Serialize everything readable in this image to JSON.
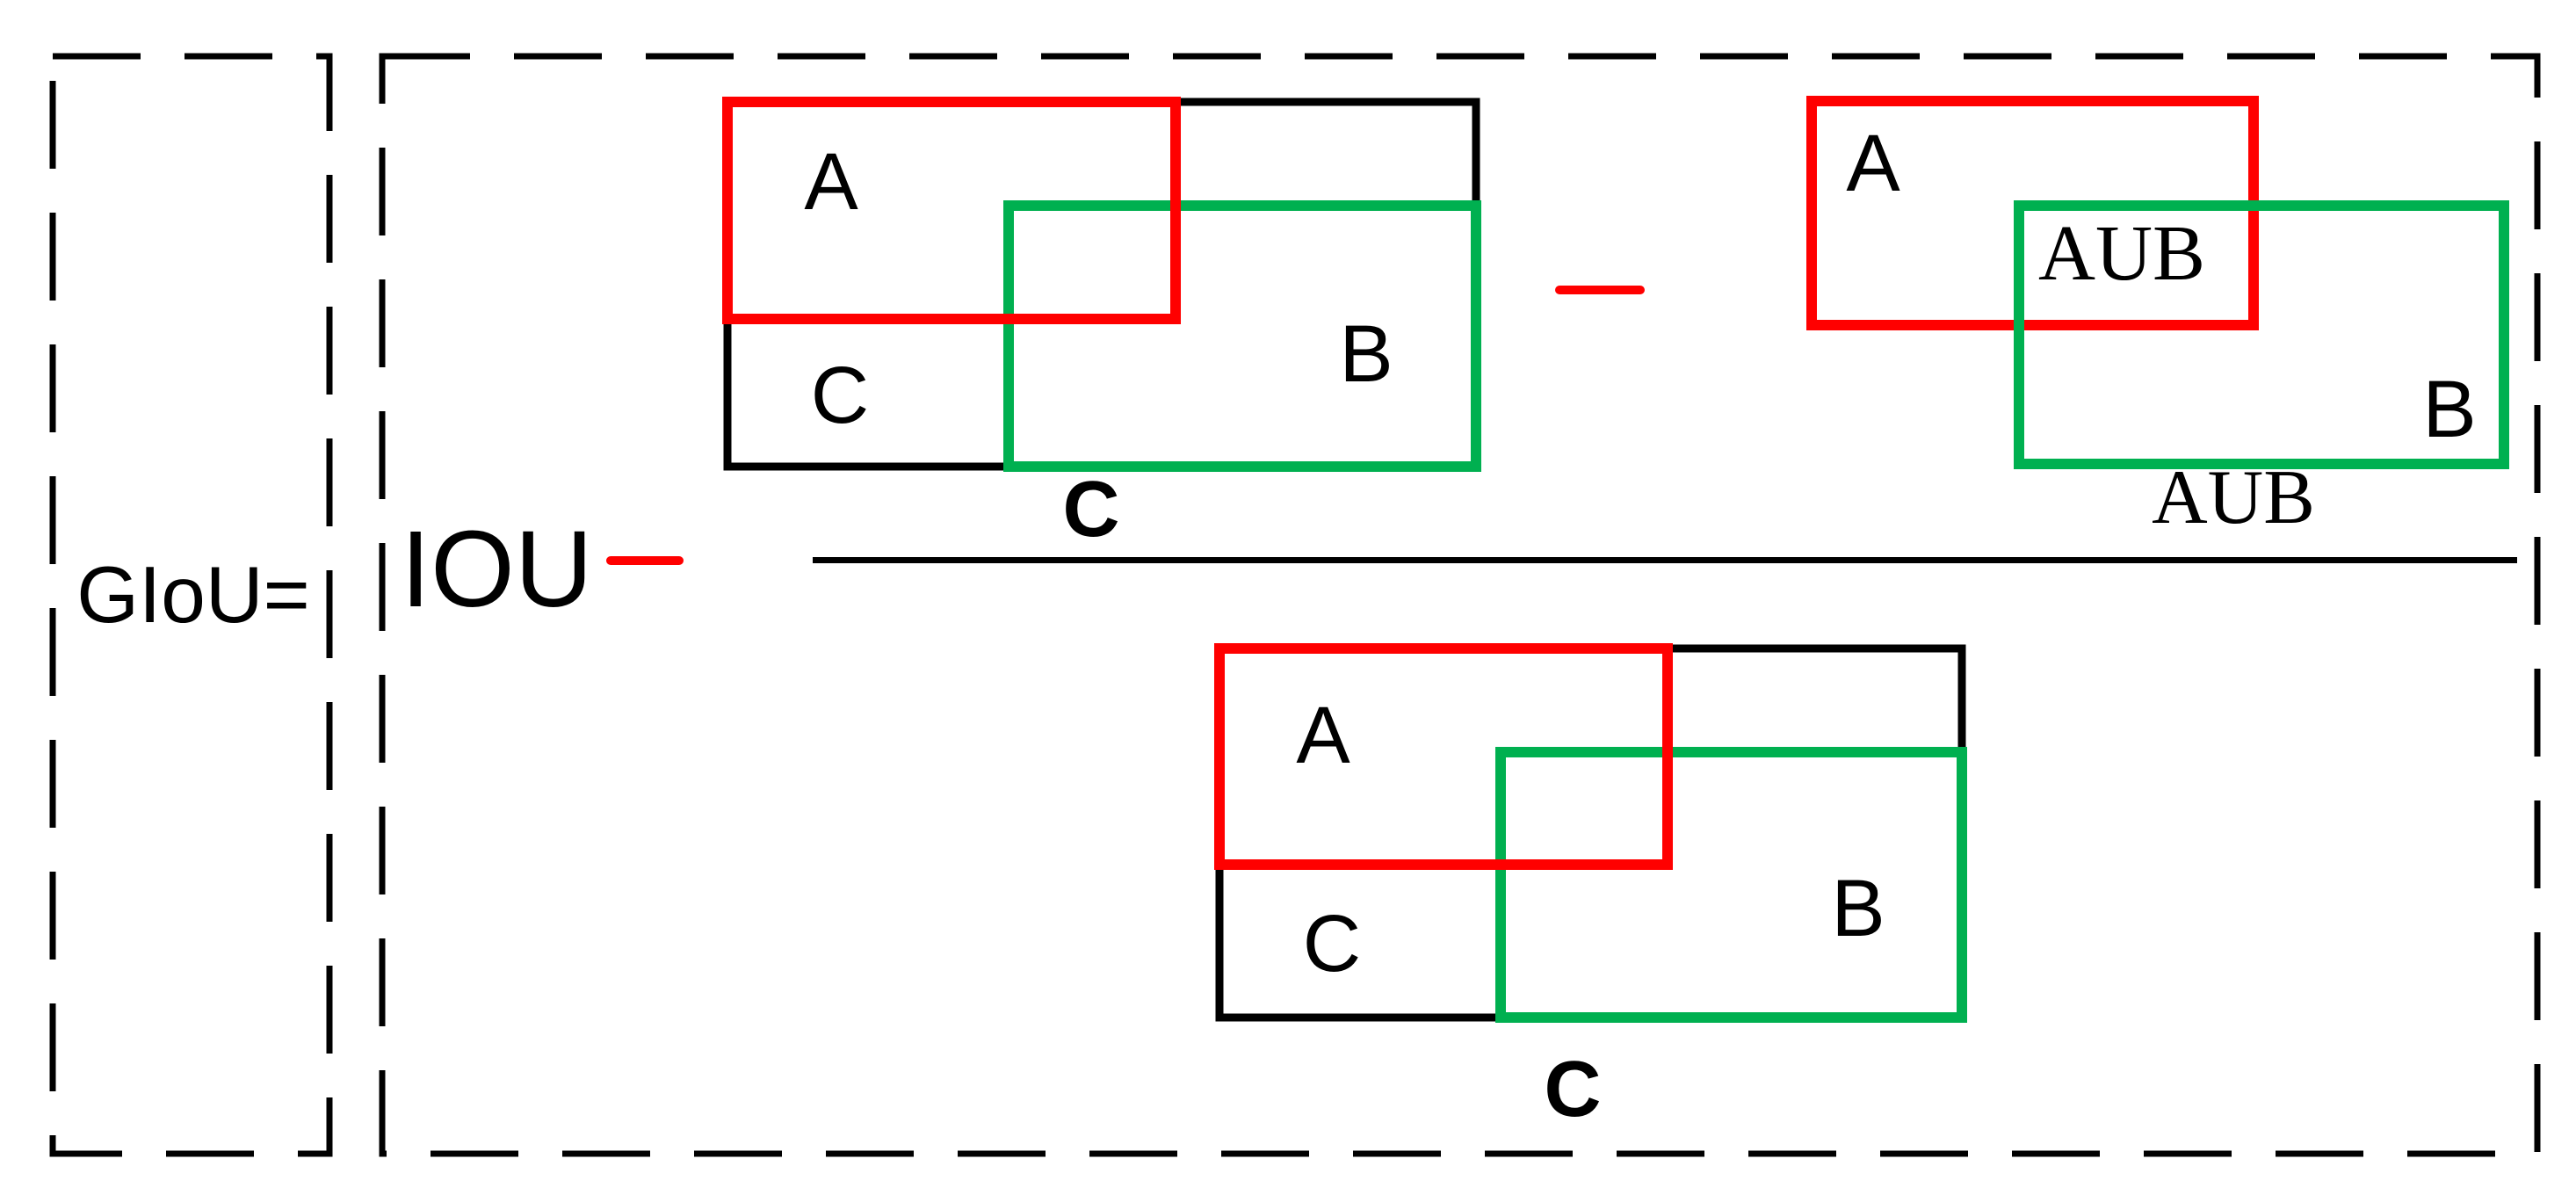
{
  "formula": {
    "lhs": "GIoU=",
    "iou": "IOU"
  },
  "numerator_diagram": {
    "box_a_label": "A",
    "box_b_label": "B",
    "box_c_label": "C",
    "caption": "C"
  },
  "union_diagram": {
    "box_a_label": "A",
    "union_label": "AUB",
    "box_b_label": "B",
    "caption": "AUB"
  },
  "denominator_diagram": {
    "box_a_label": "A",
    "box_b_label": "B",
    "box_c_label": "C",
    "caption": "C"
  },
  "colors": {
    "red": "#FF0000",
    "green": "#00B050",
    "black": "#000000",
    "salmon_fill": "#F8CBAD",
    "light_green_fill": "#C5E0B4",
    "background": "#FFFFFF"
  }
}
